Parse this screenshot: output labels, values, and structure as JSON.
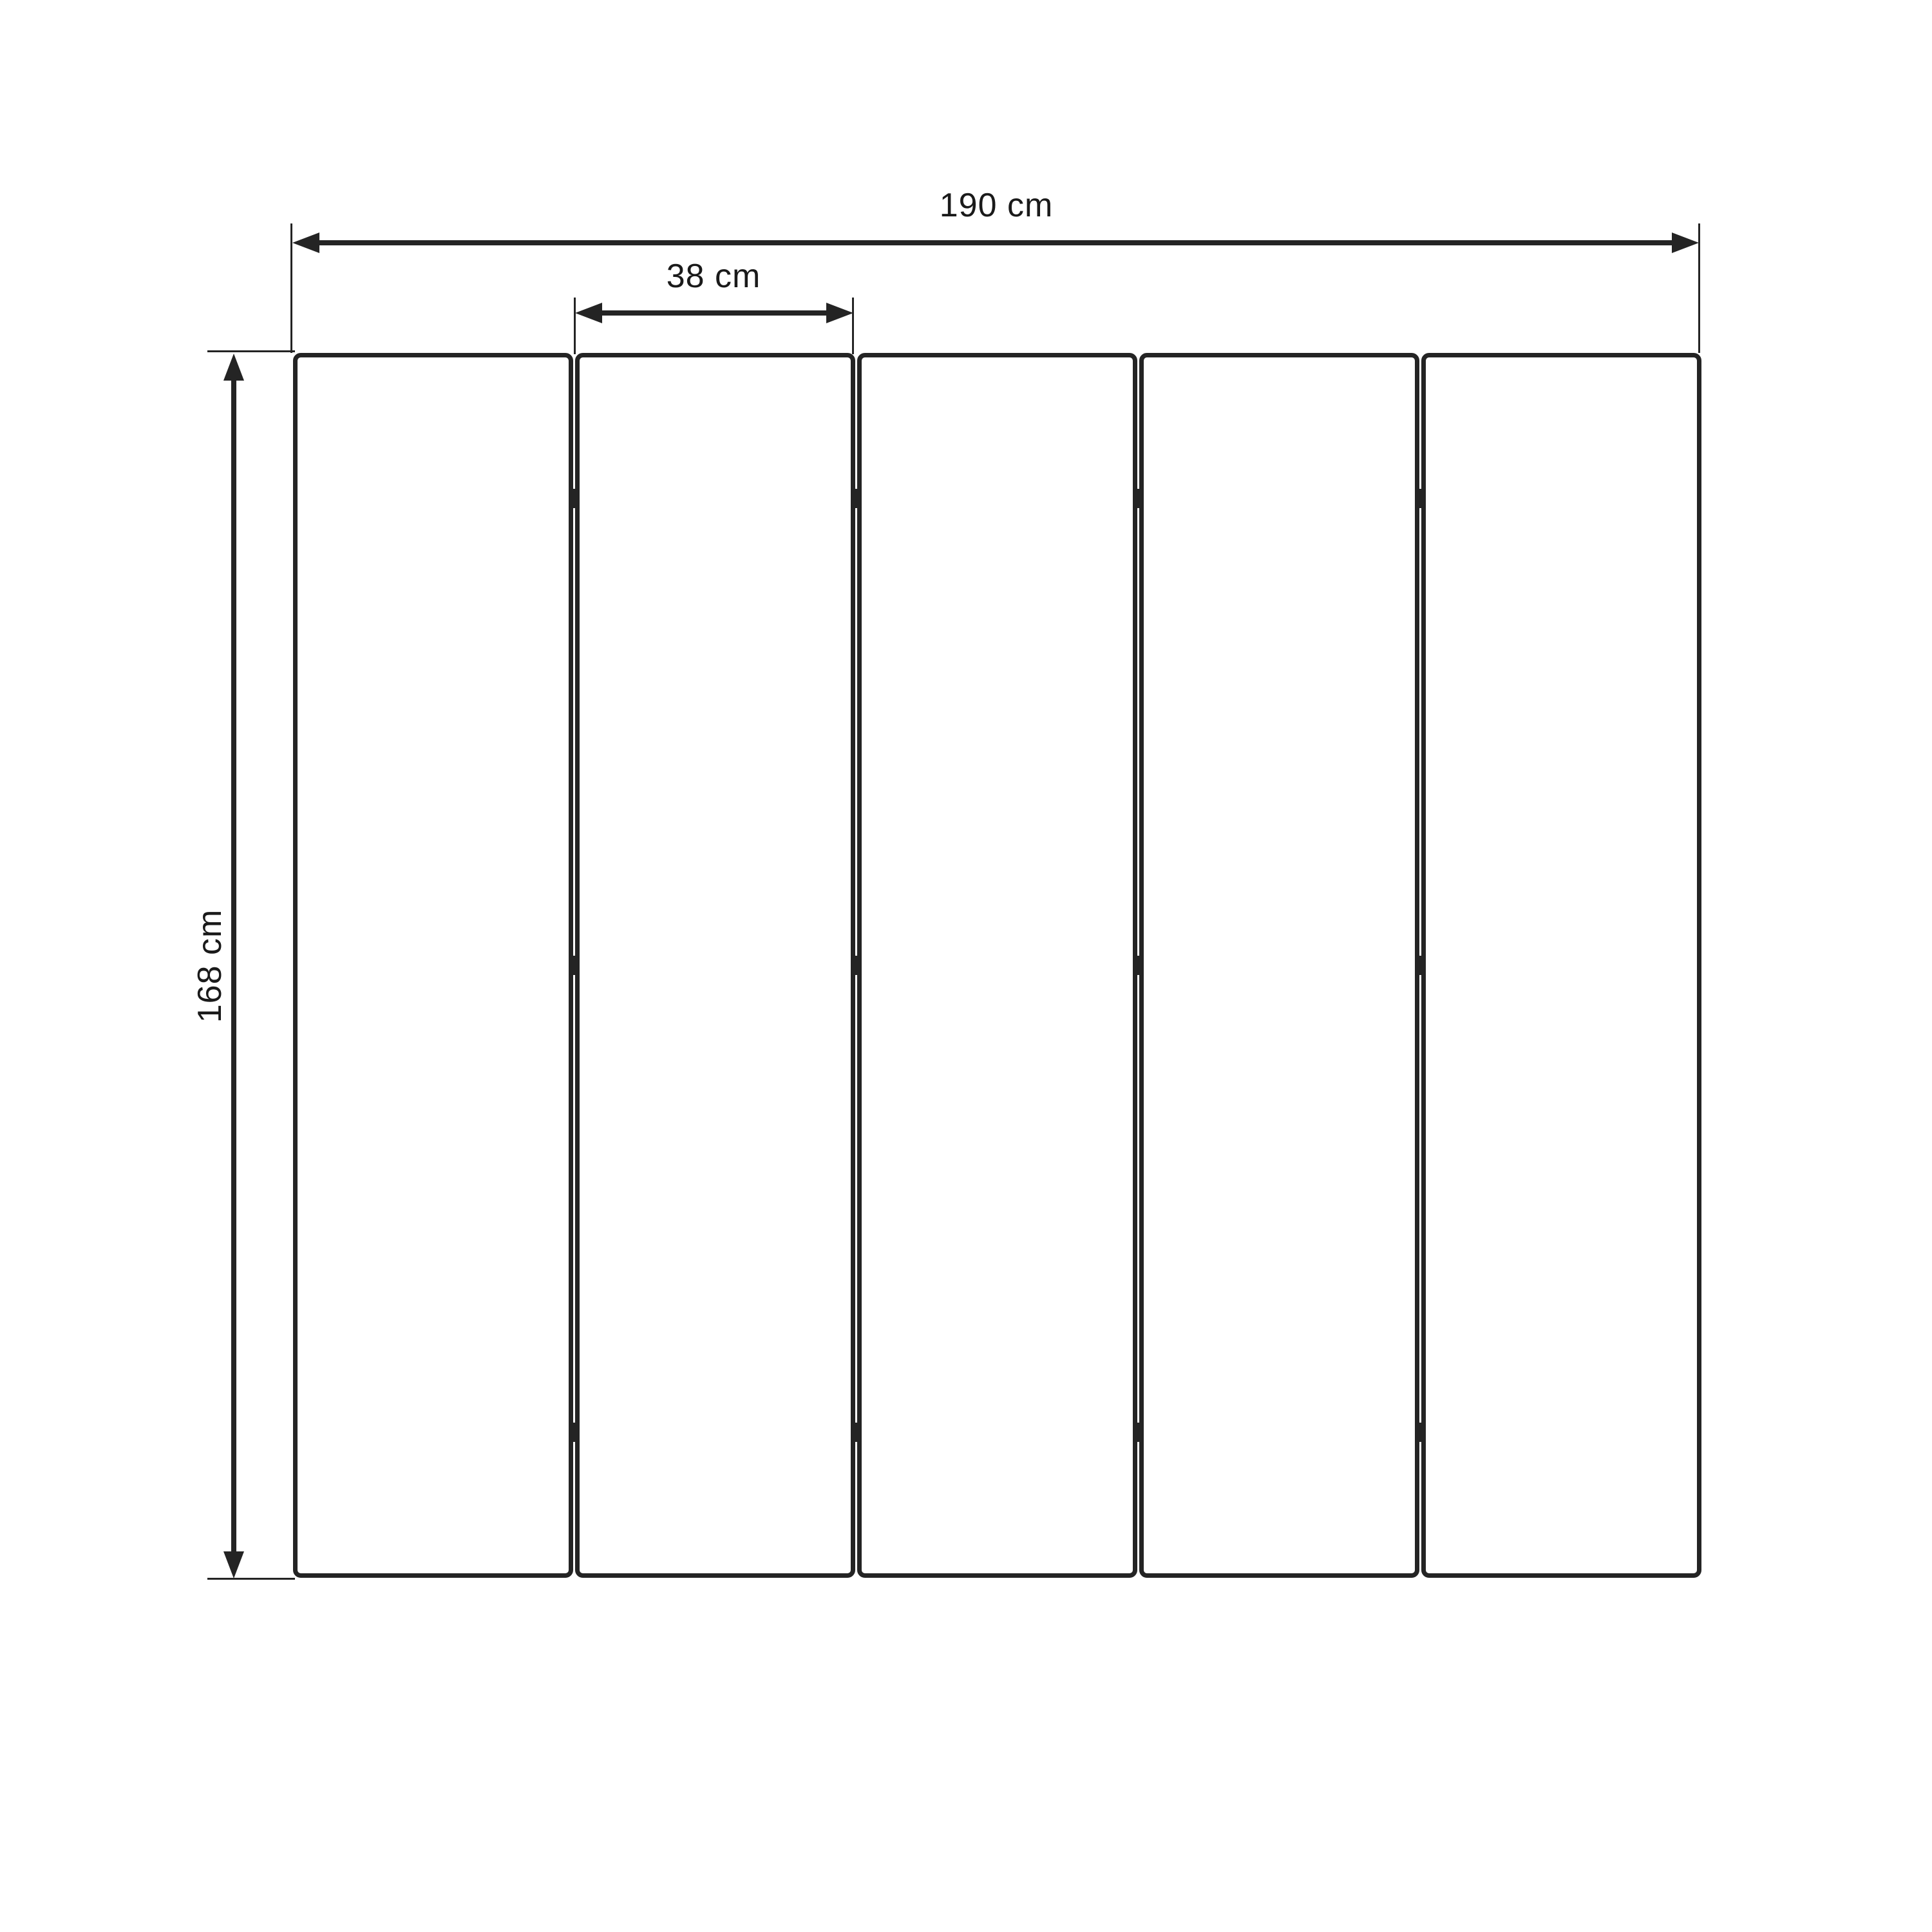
{
  "diagram": {
    "kind": "folding-screen dimension drawing",
    "background": "#ffffff",
    "stroke_color": "#242424",
    "text_color": "#1a1a1a",
    "panel_count": 5,
    "hinged_junctions": 4,
    "hinges_per_junction": 3,
    "hinge_row_fractions": [
      0.119,
      0.5,
      0.881
    ],
    "dimensions": {
      "total_width": {
        "label": "190 cm",
        "value": 190,
        "unit": "cm"
      },
      "panel_width": {
        "label": "38 cm",
        "value": 38,
        "unit": "cm"
      },
      "height": {
        "label": "168 cm",
        "value": 168,
        "unit": "cm"
      }
    }
  }
}
